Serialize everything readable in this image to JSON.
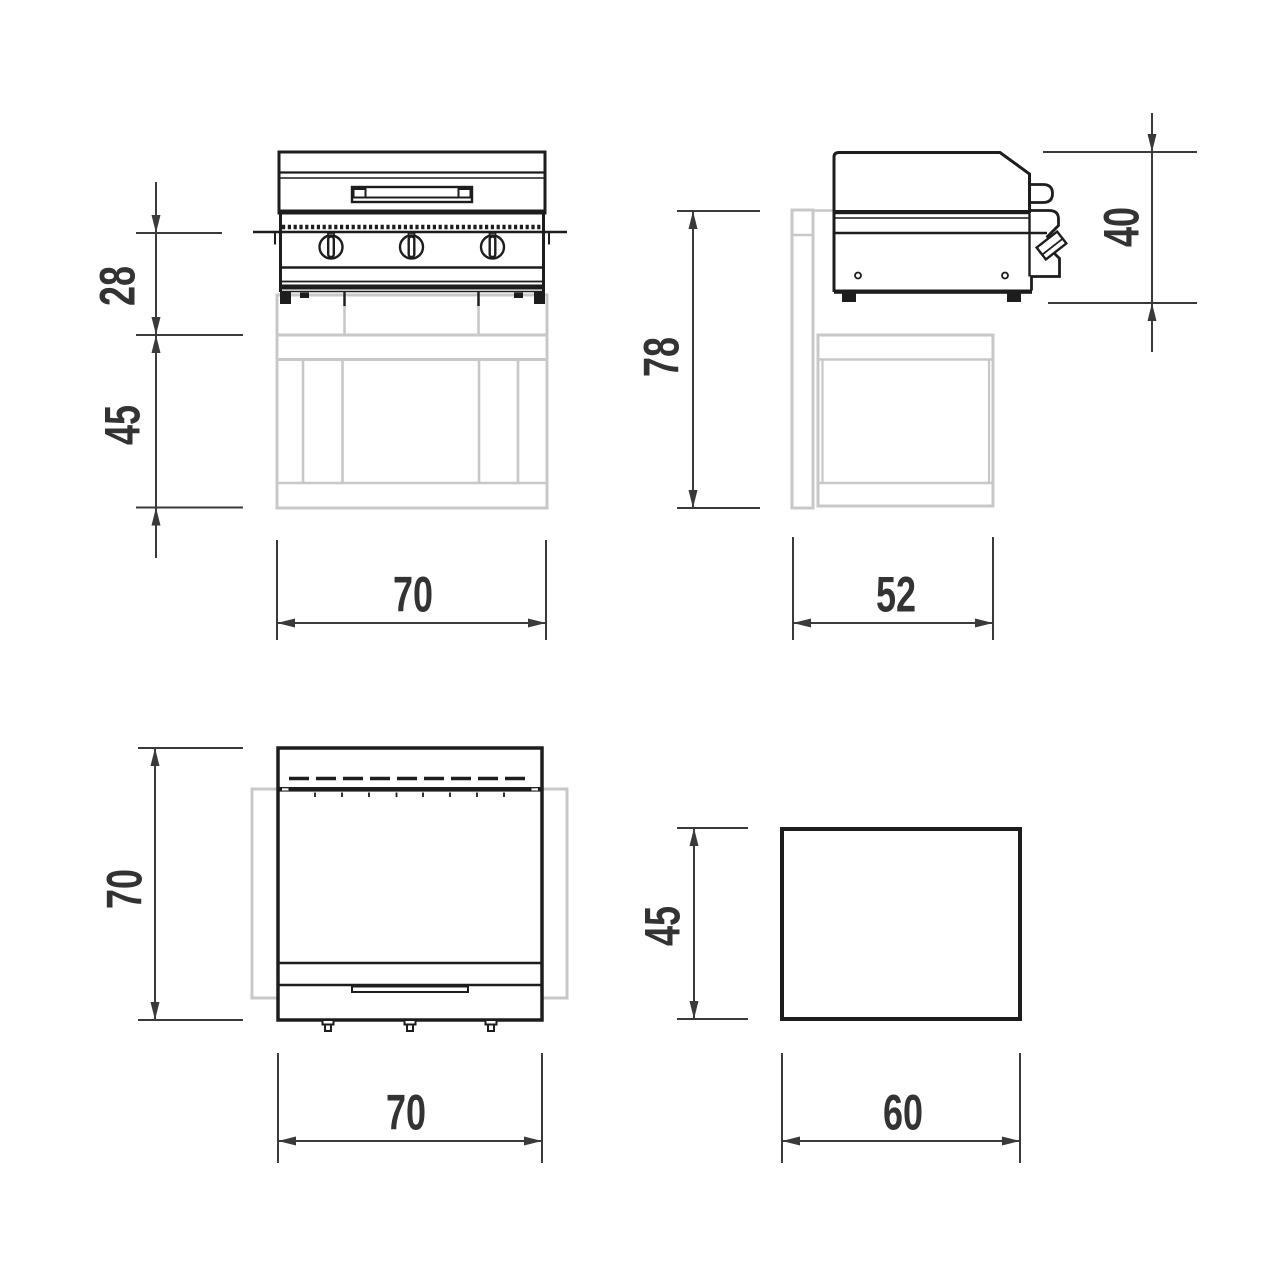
{
  "title": "appliance-dimension-drawing",
  "colors": {
    "line": "#1d1d1d",
    "ghost": "#c8c8c8",
    "dimension": "#3a3a3a",
    "text": "#333333",
    "background": "#ffffff"
  },
  "dims": {
    "front": {
      "upper_height": "28",
      "base_height": "45",
      "width": "70"
    },
    "side": {
      "total_height": "78",
      "body_height": "40",
      "base_depth": "52"
    },
    "top": {
      "depth": "70",
      "width": "70"
    },
    "base": {
      "height": "45",
      "depth": "60"
    }
  }
}
